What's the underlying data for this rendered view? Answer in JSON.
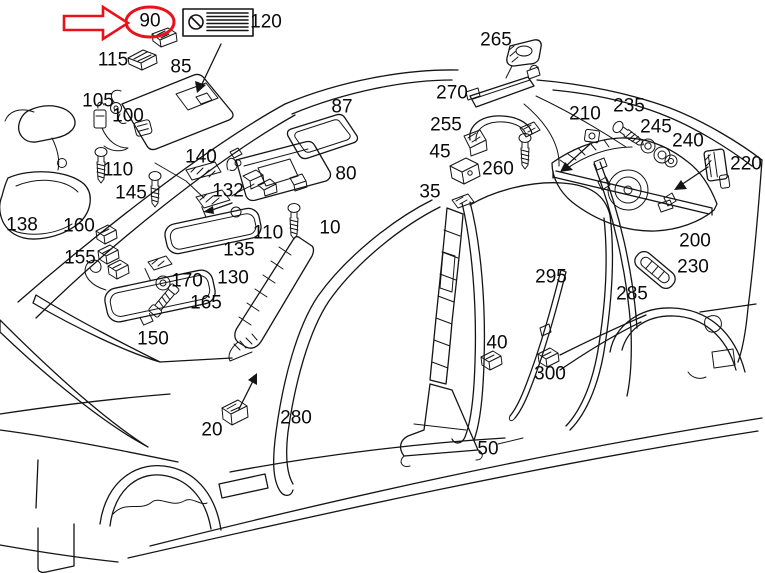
{
  "diagram": {
    "type": "exploded-parts-diagram",
    "subject": "car interior trim, pillar panels, sun visors and mirrors",
    "background_color": "#ffffff",
    "line_color": "#141414",
    "highlight": {
      "part": "90",
      "color": "#e8111c",
      "marker": "red-ellipse",
      "pointer": "red-arrow"
    },
    "label_plate_120": {
      "icon": "circle-slash-icon",
      "stripe_count": 6
    },
    "labels": [
      {
        "key": "90",
        "text": "90",
        "x": 150,
        "y": 21,
        "highlighted": true
      },
      {
        "key": "120",
        "text": "120",
        "x": 266,
        "y": 22
      },
      {
        "key": "115",
        "text": "115",
        "x": 113,
        "y": 60
      },
      {
        "key": "85",
        "text": "85",
        "x": 181,
        "y": 67
      },
      {
        "key": "105",
        "text": "105",
        "x": 98,
        "y": 101
      },
      {
        "key": "100",
        "text": "100",
        "x": 128,
        "y": 116
      },
      {
        "key": "110-front",
        "text": "110",
        "x": 118,
        "y": 170
      },
      {
        "key": "140",
        "text": "140",
        "x": 201,
        "y": 157
      },
      {
        "key": "145",
        "text": "145",
        "x": 131,
        "y": 193
      },
      {
        "key": "132",
        "text": "132",
        "x": 228,
        "y": 191
      },
      {
        "key": "110-rear",
        "text": "110",
        "x": 268,
        "y": 233
      },
      {
        "key": "135",
        "text": "135",
        "x": 239,
        "y": 250
      },
      {
        "key": "138",
        "text": "138",
        "x": 22,
        "y": 225
      },
      {
        "key": "160",
        "text": "160",
        "x": 79,
        "y": 226
      },
      {
        "key": "155",
        "text": "155",
        "x": 80,
        "y": 258
      },
      {
        "key": "170",
        "text": "170",
        "x": 187,
        "y": 281
      },
      {
        "key": "130",
        "text": "130",
        "x": 233,
        "y": 278
      },
      {
        "key": "165",
        "text": "165",
        "x": 206,
        "y": 303
      },
      {
        "key": "150",
        "text": "150",
        "x": 153,
        "y": 339
      },
      {
        "key": "20",
        "text": "20",
        "x": 212,
        "y": 430
      },
      {
        "key": "280",
        "text": "280",
        "x": 296,
        "y": 418
      },
      {
        "key": "87",
        "text": "87",
        "x": 342,
        "y": 107
      },
      {
        "key": "80",
        "text": "80",
        "x": 346,
        "y": 174
      },
      {
        "key": "10",
        "text": "10",
        "x": 330,
        "y": 228
      },
      {
        "key": "35",
        "text": "35",
        "x": 430,
        "y": 192
      },
      {
        "key": "45",
        "text": "45",
        "x": 440,
        "y": 152
      },
      {
        "key": "255",
        "text": "255",
        "x": 446,
        "y": 125
      },
      {
        "key": "270",
        "text": "270",
        "x": 452,
        "y": 93
      },
      {
        "key": "265",
        "text": "265",
        "x": 496,
        "y": 40
      },
      {
        "key": "260",
        "text": "260",
        "x": 498,
        "y": 169
      },
      {
        "key": "210",
        "text": "210",
        "x": 585,
        "y": 114
      },
      {
        "key": "235",
        "text": "235",
        "x": 629,
        "y": 106
      },
      {
        "key": "245",
        "text": "245",
        "x": 656,
        "y": 127
      },
      {
        "key": "240",
        "text": "240",
        "x": 688,
        "y": 141
      },
      {
        "key": "220",
        "text": "220",
        "x": 746,
        "y": 164
      },
      {
        "key": "200",
        "text": "200",
        "x": 695,
        "y": 241
      },
      {
        "key": "230",
        "text": "230",
        "x": 693,
        "y": 267
      },
      {
        "key": "285",
        "text": "285",
        "x": 632,
        "y": 294
      },
      {
        "key": "295",
        "text": "295",
        "x": 551,
        "y": 277
      },
      {
        "key": "40",
        "text": "40",
        "x": 497,
        "y": 343
      },
      {
        "key": "300",
        "text": "300",
        "x": 550,
        "y": 374
      },
      {
        "key": "50",
        "text": "50",
        "x": 488,
        "y": 449
      }
    ]
  }
}
